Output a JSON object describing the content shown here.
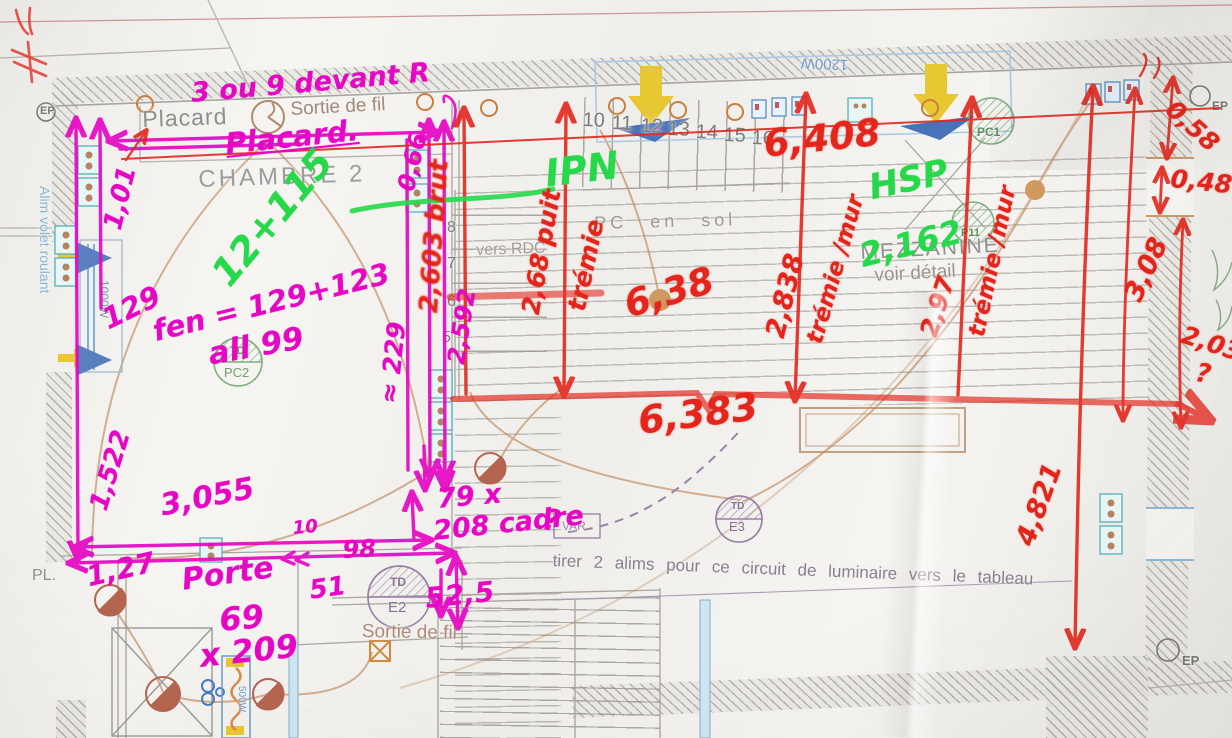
{
  "colors": {
    "magenta": "#e607c4",
    "red": "#e3251b",
    "green": "#27d84a"
  },
  "hand_magenta": {
    "note_top": "3 ou 9 devant R",
    "placard": "Placard.",
    "dim_1_01": "1,01",
    "dim_129": "129",
    "fenetre": "fen = 129+123",
    "allege": "all 99",
    "dim_1_522": "1,522",
    "dim_3_055": "3,055",
    "dim_10": "10",
    "dim_98": "98",
    "dim_1_27": "1,27",
    "porte": "Porte",
    "porte_l": "69",
    "porte_h": "x 209",
    "dim_51": "51",
    "dim_52_5": "52,5",
    "cadre_1": "79 x",
    "cadre_2": "208 cadre",
    "dim_2_592": "2,592",
    "dim_0_66": "0,66",
    "dim_229": "≈ 229",
    "question": "?"
  },
  "hand_red": {
    "dim_6_408": "6,408",
    "dim_6_38": "6,38",
    "dim_6_383": "6,383",
    "puit": "2,68 puit",
    "tremie": "trémie",
    "dim_2_838": "2,838",
    "tremie_mur_1": "trémie /mur",
    "dim_2_97": "2,97",
    "tremie_mur_2": "trémie /mur",
    "dim_2_603": "2,603 brut",
    "dim_3_08": "3,08",
    "dim_4_821": "4,821",
    "dim_0_58": "0,58",
    "dim_0_48": "0,48",
    "dim_2_03": "2,03",
    "question": "?"
  },
  "hand_green": {
    "ipn": "IPN",
    "hsp": "HSP",
    "dim_2_162": "2,162",
    "fen_note": "12+115"
  },
  "printed": {
    "placard": "Placard",
    "sortie_de_fil_top": "Sortie de fil",
    "chambre": "CHAMBRE 2",
    "vers_rdc": "vers RDC",
    "pc_en_sol": "PC en sol",
    "mezzanine": "MEZZANINE",
    "voir_detail": "voir détail",
    "note_luminaire": "tirer 2 alims pour ce circuit de luminaire vers le tableau",
    "alim_volet": "Alim volet roulant",
    "pl": "PL.",
    "ep": "EP",
    "var": "VAR",
    "w1200": "1200W",
    "w1000": "1000W",
    "w500": "500W",
    "sortie_de_fil_bottom": "Sortie de fil"
  },
  "stairs": {
    "top_numbers": [
      "10",
      "11",
      "12",
      "13",
      "14",
      "15",
      "16"
    ],
    "left_numbers": [
      "8",
      "7",
      "6",
      "5"
    ]
  },
  "symbols": {
    "td": "TD",
    "pc2": "PC2",
    "e2": "E2",
    "e3": "E3",
    "pc1": "PC1",
    "p11": "P11"
  }
}
